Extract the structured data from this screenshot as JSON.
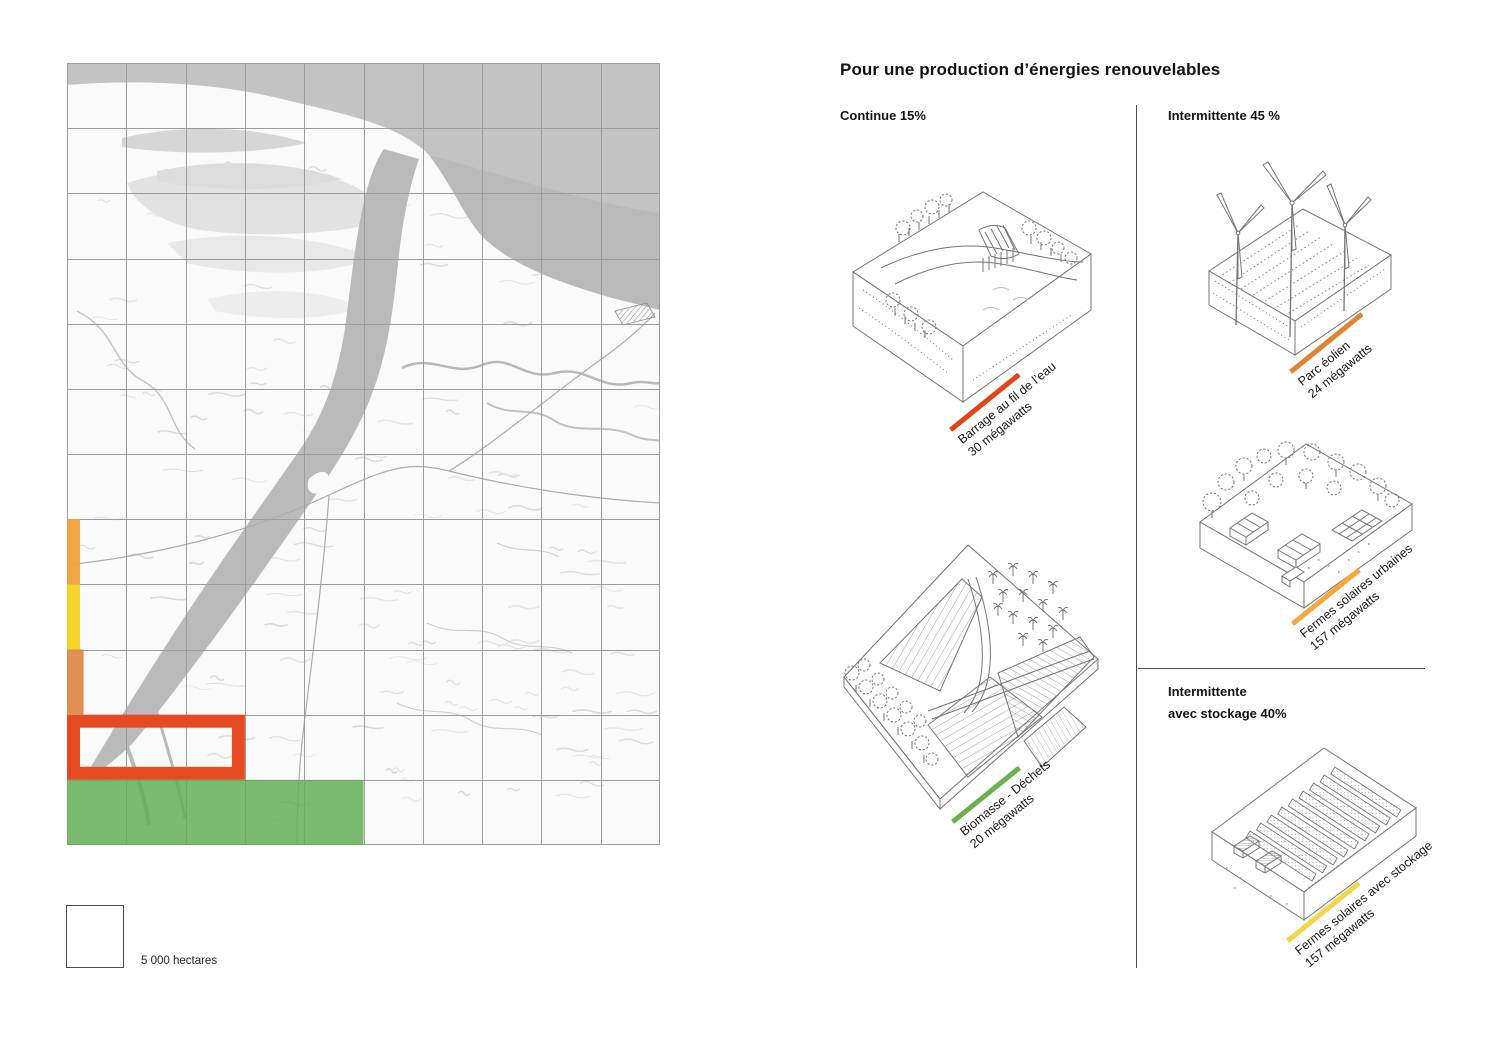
{
  "page": {
    "background": "#FFFFFF"
  },
  "map": {
    "name": "land-use-map-river-delta",
    "grid": {
      "cols": 10,
      "rows": 12
    },
    "legend": {
      "label": "5 000 hectares"
    },
    "overlays": [
      {
        "name": "orange-strip",
        "type": "fill",
        "col": 0,
        "row": 7,
        "w": 0.22,
        "h": 1,
        "color": "#F0A13B",
        "opacity": 0.95
      },
      {
        "name": "yellow-strip",
        "type": "fill",
        "col": 0,
        "row": 8,
        "w": 0.22,
        "h": 1,
        "color": "#F4D21F",
        "opacity": 0.95
      },
      {
        "name": "dark-orange-strip",
        "type": "fill",
        "col": 0,
        "row": 9,
        "w": 0.28,
        "h": 1,
        "color": "#DE8A49",
        "opacity": 0.95
      },
      {
        "name": "red-outline-zone",
        "type": "outline",
        "col": 0,
        "row": 10,
        "w": 3,
        "h": 1,
        "color": "#E64A20",
        "stroke": 13
      },
      {
        "name": "green-zone",
        "type": "fill",
        "col": 0,
        "row": 11,
        "w": 5,
        "h": 1,
        "color": "#62AE55",
        "opacity": 0.85
      }
    ],
    "colors": {
      "sea": "#C3C3C3",
      "river": "#BABABA",
      "gridline": "#9C9C9C"
    }
  },
  "panel": {
    "title": "Pour une production d’énergies renouvelables",
    "sections": {
      "continue": {
        "label": "Continue 15%"
      },
      "intermittente": {
        "label": "Intermittente 45 %"
      },
      "stockage": {
        "label_line1": "Intermittente",
        "label_line2": "avec stockage 40%"
      }
    },
    "items": [
      {
        "name": "barrage",
        "illustration": "dam-run-of-river-icon",
        "line1": "Barrage au fil de l’eau",
        "line2": "30 mégawatts",
        "color": "#E2421C"
      },
      {
        "name": "biomasse",
        "illustration": "biomass-fields-icon",
        "line1": "Biomasse - Déchets",
        "line2": "20 mégawatts",
        "color": "#6CB14E"
      },
      {
        "name": "eolien",
        "illustration": "wind-farm-icon",
        "line1": "Parc éolien",
        "line2": "24 mégawatts",
        "color": "#E08434"
      },
      {
        "name": "solaires-urbaines",
        "illustration": "urban-solar-icon",
        "line1": "Fermes solaires urbaines",
        "line2": "157 mégawatts",
        "color": "#F6A83C"
      },
      {
        "name": "solaires-stockage",
        "illustration": "solar-storage-icon",
        "line1": "Fermes solaires avec stockage",
        "line2": "157 mégawatts",
        "color": "#F6D44A"
      }
    ]
  }
}
